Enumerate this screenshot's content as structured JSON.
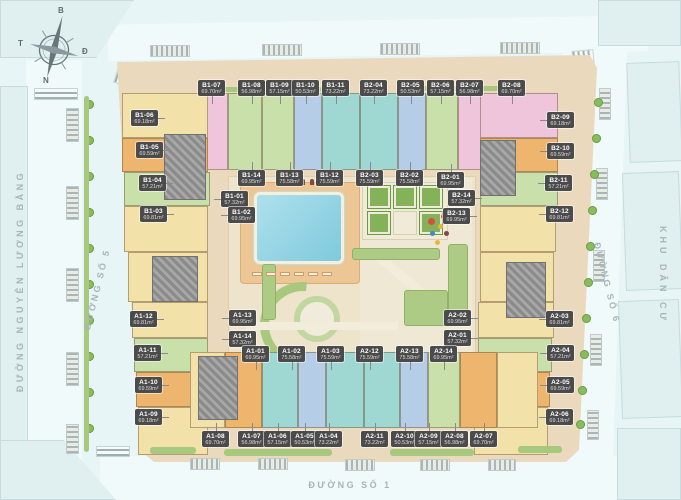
{
  "colors": {
    "background": "#e7f5f6",
    "site": "#ead9bd",
    "courtyard": "#eee3cb",
    "pool": "#7ecadd",
    "deck": "#ecc795",
    "badge": "#4b4b4b",
    "street_text": "#a7b5b6",
    "units": {
      "y": "#f2e2a9",
      "o": "#edb56e",
      "p": "#eec5db",
      "g": "#c9e0ab",
      "t": "#9fd8d2",
      "b": "#b6cde8"
    }
  },
  "compass": {
    "north": "B",
    "east": "Đ",
    "south": "N",
    "west": "T"
  },
  "streets": {
    "left": "ĐƯỜNG NGUYỄN LƯƠNG BẰNG",
    "inner_left": "ĐƯỜNG SỐ 5",
    "bottom": "ĐƯỜNG SỐ 1",
    "inner_right": "ĐƯỜNG SỐ 6",
    "right_district": "KHU DÂN CƯ"
  },
  "area_unit": "m²",
  "units": [
    [
      "B1-07",
      "69.70m²",
      198,
      80,
      "d"
    ],
    [
      "B1-08",
      "56.98m²",
      238,
      80,
      "d"
    ],
    [
      "B1-09",
      "57.15m²",
      266,
      80,
      "d"
    ],
    [
      "B1-10",
      "50.53m²",
      292,
      80,
      "d"
    ],
    [
      "B1-11",
      "73.22m²",
      322,
      80,
      "d"
    ],
    [
      "B2-04",
      "73.22m²",
      360,
      80,
      "d"
    ],
    [
      "B2-05",
      "50.53m²",
      397,
      80,
      "d"
    ],
    [
      "B2-06",
      "57.15m²",
      427,
      80,
      "d"
    ],
    [
      "B2-07",
      "56.98m²",
      456,
      80,
      "d"
    ],
    [
      "B2-08",
      "69.70m²",
      498,
      80,
      "d"
    ],
    [
      "B1-06",
      "69.18m²",
      131,
      110,
      "r"
    ],
    [
      "B1-05",
      "69.59m²",
      136,
      142,
      "r"
    ],
    [
      "B1-04",
      "57.21m²",
      139,
      175,
      "r"
    ],
    [
      "B1-03",
      "69.81m²",
      140,
      206,
      "r"
    ],
    [
      "B2-09",
      "69.18m²",
      547,
      112,
      "l"
    ],
    [
      "B2-10",
      "69.59m²",
      547,
      143,
      "l"
    ],
    [
      "B2-11",
      "57.21m²",
      545,
      175,
      "l"
    ],
    [
      "B2-12",
      "69.81m²",
      546,
      206,
      "l"
    ],
    [
      "B1-14",
      "69.95m²",
      238,
      170,
      "u"
    ],
    [
      "B1-13",
      "75.58m²",
      276,
      170,
      "u"
    ],
    [
      "B1-12",
      "75.59m²",
      316,
      170,
      "u"
    ],
    [
      "B2-03",
      "75.59m²",
      356,
      170,
      "u"
    ],
    [
      "B2-02",
      "75.58m²",
      396,
      170,
      "u"
    ],
    [
      "B2-01",
      "69.95m²",
      437,
      172,
      "u"
    ],
    [
      "B1-01",
      "57.32m²",
      221,
      191,
      "l"
    ],
    [
      "B1-02",
      "69.95m²",
      228,
      207,
      "l"
    ],
    [
      "B2-14",
      "57.32m²",
      448,
      190,
      "r"
    ],
    [
      "B2-13",
      "69.95m²",
      443,
      208,
      "r"
    ],
    [
      "A1-12",
      "69.81m²",
      130,
      311,
      "r"
    ],
    [
      "A1-11",
      "57.21m²",
      134,
      345,
      "r"
    ],
    [
      "A1-10",
      "69.59m²",
      135,
      377,
      "r"
    ],
    [
      "A1-09",
      "69.18m²",
      135,
      409,
      "r"
    ],
    [
      "A2-03",
      "69.81m²",
      546,
      311,
      "l"
    ],
    [
      "A2-04",
      "57.21m²",
      547,
      345,
      "l"
    ],
    [
      "A2-05",
      "69.59m²",
      547,
      377,
      "l"
    ],
    [
      "A2-06",
      "69.18m²",
      546,
      409,
      "l"
    ],
    [
      "A1-13",
      "69.95m²",
      229,
      310,
      "l"
    ],
    [
      "A1-14",
      "57.32m²",
      229,
      331,
      "l"
    ],
    [
      "A2-02",
      "69.95m²",
      444,
      310,
      "r"
    ],
    [
      "A2-01",
      "57.32m²",
      444,
      330,
      "r"
    ],
    [
      "A1-01",
      "69.95m²",
      242,
      346,
      "d"
    ],
    [
      "A1-02",
      "75.58m²",
      278,
      346,
      "d"
    ],
    [
      "A1-03",
      "75.59m²",
      317,
      346,
      "d"
    ],
    [
      "A2-12",
      "75.59m²",
      356,
      346,
      "d"
    ],
    [
      "A2-13",
      "75.58m²",
      396,
      346,
      "d"
    ],
    [
      "A2-14",
      "69.95m²",
      430,
      346,
      "d"
    ],
    [
      "A1-08",
      "69.70m²",
      202,
      431,
      "u"
    ],
    [
      "A1-07",
      "56.98m²",
      238,
      431,
      "u"
    ],
    [
      "A1-06",
      "57.15m²",
      264,
      431,
      "u"
    ],
    [
      "A1-05",
      "50.53m²",
      291,
      431,
      "u"
    ],
    [
      "A1-04",
      "73.22m²",
      315,
      431,
      "u"
    ],
    [
      "A2-11",
      "73.22m²",
      361,
      431,
      "u"
    ],
    [
      "A2-10",
      "50.53m²",
      391,
      431,
      "u"
    ],
    [
      "A2-09",
      "57.15m²",
      415,
      431,
      "u"
    ],
    [
      "A2-08",
      "56.98m²",
      441,
      431,
      "u"
    ],
    [
      "A2-07",
      "69.70m²",
      470,
      431,
      "u"
    ]
  ],
  "site": {
    "blocks": [
      [
        190,
        93,
        38,
        77,
        "p"
      ],
      [
        228,
        93,
        34,
        77,
        "g"
      ],
      [
        262,
        93,
        32,
        77,
        "g"
      ],
      [
        294,
        93,
        28,
        77,
        "b"
      ],
      [
        322,
        93,
        38,
        77,
        "t"
      ],
      [
        360,
        93,
        38,
        77,
        "t"
      ],
      [
        398,
        93,
        28,
        77,
        "b"
      ],
      [
        426,
        93,
        32,
        77,
        "g"
      ],
      [
        458,
        93,
        38,
        77,
        "p"
      ],
      [
        496,
        93,
        42,
        77,
        "y"
      ],
      [
        122,
        93,
        86,
        45,
        "y"
      ],
      [
        122,
        138,
        86,
        34,
        "o"
      ],
      [
        124,
        172,
        86,
        34,
        "g"
      ],
      [
        124,
        206,
        84,
        46,
        "y"
      ],
      [
        128,
        252,
        80,
        50,
        "y"
      ],
      [
        132,
        302,
        76,
        36,
        "y"
      ],
      [
        134,
        338,
        74,
        34,
        "g"
      ],
      [
        136,
        372,
        72,
        35,
        "o"
      ],
      [
        138,
        407,
        70,
        48,
        "y"
      ],
      [
        480,
        93,
        78,
        45,
        "p"
      ],
      [
        480,
        138,
        78,
        34,
        "o"
      ],
      [
        480,
        172,
        78,
        34,
        "g"
      ],
      [
        480,
        206,
        76,
        46,
        "y"
      ],
      [
        480,
        252,
        74,
        50,
        "y"
      ],
      [
        478,
        302,
        76,
        36,
        "y"
      ],
      [
        478,
        338,
        74,
        34,
        "g"
      ],
      [
        476,
        372,
        74,
        35,
        "o"
      ],
      [
        474,
        407,
        74,
        48,
        "y"
      ],
      [
        190,
        352,
        35,
        76,
        "y"
      ],
      [
        225,
        352,
        37,
        76,
        "o"
      ],
      [
        262,
        352,
        36,
        76,
        "t"
      ],
      [
        298,
        352,
        28,
        76,
        "b"
      ],
      [
        326,
        352,
        38,
        76,
        "t"
      ],
      [
        364,
        352,
        36,
        76,
        "t"
      ],
      [
        400,
        352,
        28,
        76,
        "b"
      ],
      [
        428,
        352,
        32,
        76,
        "g"
      ],
      [
        460,
        352,
        37,
        76,
        "o"
      ],
      [
        497,
        352,
        41,
        76,
        "y"
      ]
    ],
    "cores": [
      [
        164,
        134,
        42,
        66
      ],
      [
        480,
        140,
        36,
        56
      ],
      [
        152,
        256,
        46,
        46
      ],
      [
        506,
        262,
        40,
        56
      ],
      [
        198,
        356,
        40,
        64
      ]
    ]
  },
  "decor": {
    "hatches": [
      [
        66,
        108,
        13,
        34,
        "h"
      ],
      [
        66,
        186,
        13,
        34,
        "h"
      ],
      [
        66,
        268,
        13,
        34,
        "h"
      ],
      [
        66,
        352,
        13,
        34,
        "h"
      ],
      [
        66,
        424,
        13,
        30,
        "h"
      ],
      [
        599,
        88,
        12,
        32,
        "h"
      ],
      [
        596,
        168,
        12,
        32,
        "h"
      ],
      [
        593,
        250,
        12,
        32,
        "h"
      ],
      [
        590,
        334,
        12,
        32,
        "h"
      ],
      [
        587,
        410,
        12,
        30,
        "h"
      ],
      [
        150,
        45,
        40,
        12,
        "v"
      ],
      [
        262,
        44,
        40,
        12,
        "v"
      ],
      [
        380,
        43,
        40,
        12,
        "v"
      ],
      [
        500,
        42,
        40,
        12,
        "v"
      ],
      [
        190,
        458,
        30,
        12,
        "v"
      ],
      [
        258,
        458,
        30,
        12,
        "v"
      ],
      [
        345,
        459,
        30,
        12,
        "v"
      ],
      [
        420,
        459,
        30,
        12,
        "v"
      ],
      [
        488,
        459,
        28,
        12,
        "v"
      ]
    ],
    "bushes": [
      [
        85,
        100
      ],
      [
        85,
        136
      ],
      [
        85,
        172
      ],
      [
        85,
        208
      ],
      [
        85,
        244
      ],
      [
        85,
        280
      ],
      [
        85,
        316
      ],
      [
        85,
        352
      ],
      [
        85,
        388
      ],
      [
        85,
        424
      ],
      [
        594,
        98
      ],
      [
        592,
        134
      ],
      [
        590,
        170
      ],
      [
        588,
        206
      ],
      [
        586,
        242
      ],
      [
        584,
        278
      ],
      [
        582,
        314
      ],
      [
        580,
        350
      ],
      [
        578,
        386
      ],
      [
        576,
        420
      ]
    ],
    "hedges": [
      [
        150,
        447,
        46,
        7
      ],
      [
        224,
        449,
        108,
        7
      ],
      [
        390,
        449,
        84,
        7
      ],
      [
        518,
        446,
        44,
        7
      ],
      [
        212,
        87,
        110,
        5
      ],
      [
        420,
        86,
        96,
        5
      ],
      [
        84,
        96,
        5,
        356
      ]
    ],
    "lawns": [
      [
        352,
        248,
        88,
        12
      ],
      [
        448,
        244,
        20,
        80
      ],
      [
        262,
        264,
        14,
        56
      ],
      [
        404,
        290,
        44,
        36
      ]
    ],
    "plaza": [
      [
        368,
        186
      ],
      [
        394,
        186
      ],
      [
        420,
        186
      ],
      [
        368,
        212
      ],
      [
        420,
        212
      ]
    ],
    "plaza_white": [
      [
        394,
        212
      ]
    ],
    "play": [
      [
        428,
        218,
        "#d94f3d",
        7
      ],
      [
        438,
        224,
        "#e8b73a",
        5
      ],
      [
        430,
        231,
        "#4a86c5",
        5
      ],
      [
        441,
        214,
        "#d94f3d",
        5
      ],
      [
        444,
        231,
        "#7d4b43",
        5
      ],
      [
        435,
        240,
        "#e8b73a",
        5
      ]
    ],
    "loungers": [
      [
        252,
        272
      ],
      [
        266,
        272
      ],
      [
        280,
        272
      ],
      [
        294,
        272
      ],
      [
        308,
        272
      ],
      [
        322,
        272
      ]
    ],
    "people": [
      [
        292,
        179
      ],
      [
        301,
        179
      ],
      [
        310,
        179
      ],
      [
        319,
        179
      ],
      [
        328,
        179
      ]
    ]
  }
}
